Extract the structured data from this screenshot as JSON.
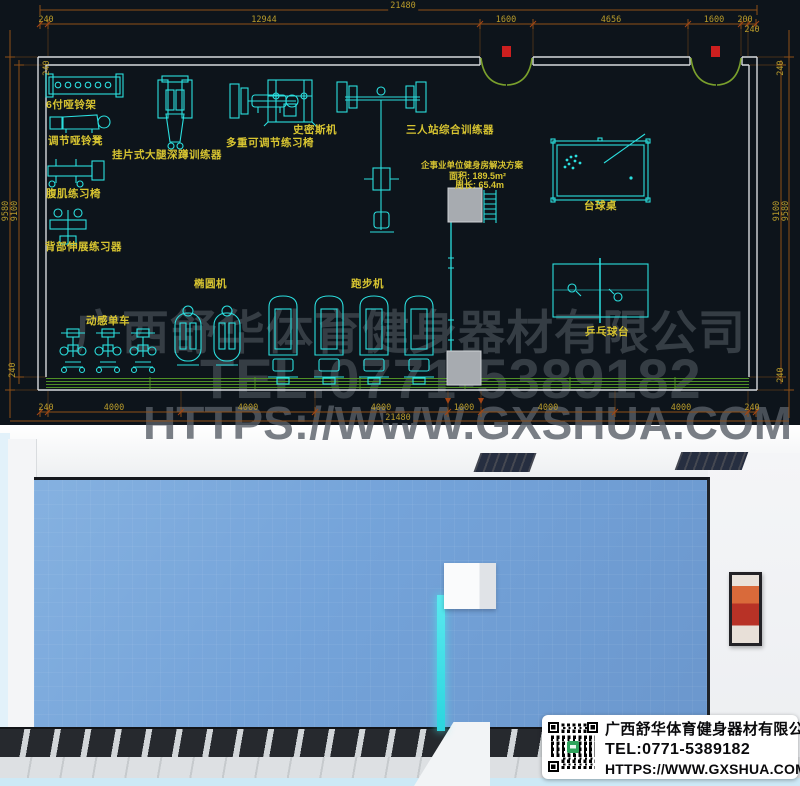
{
  "company": {
    "name": "广西舒华体育健身器材有限公司",
    "tel": "TEL:0771-5389182",
    "url": "HTTPS://WWW.GXSHUA.COM"
  },
  "plan": {
    "solution": {
      "title": "企事业单位健身房解决方案",
      "area": "面积: 189.5m²",
      "perimeter": "周长: 65.4m"
    },
    "labels": {
      "dumbbell_rack": "6付哑铃架",
      "adj_dumbbell_bench": "调节哑铃凳",
      "ab_chair": "腹肌练习椅",
      "back_extension": "背部伸展练习器",
      "squat_trainer": "挂片式大腿深蹲训练器",
      "multi_adj_bench": "多重可调节练习椅",
      "smith_machine": "史密斯机",
      "three_station": "三人站综合训练器",
      "pool_table": "台球桌",
      "pingpong_table": "乒乓球台",
      "elliptical": "椭圆机",
      "treadmill": "跑步机",
      "spin_bike": "动感单车"
    },
    "dimensions": {
      "total": "21480",
      "top_row": [
        "240",
        "12944",
        "1600",
        "4656",
        "1600",
        "200",
        "240"
      ],
      "bottom_row": [
        "240",
        "4000",
        "4000",
        "4000",
        "1000",
        "4000",
        "4000",
        "240"
      ],
      "side": {
        "wall": "240",
        "inner": "9100",
        "outer": "9580"
      }
    }
  },
  "colors": {
    "cad_background": "#0d141b",
    "cad_line_cyan": "#2bdfdf",
    "cad_label_yellow": "#d8c531",
    "cad_dim_orange": "#8e4f17",
    "cad_dim_text": "#b89b2b",
    "wall_white": "#d7dadd",
    "door_green": "#7aa02c",
    "door_marker_red": "#cc1f1f",
    "floor_blue": "#74a3d9",
    "pool_felt_green": "#2e7c33",
    "pingpong_blue": "#3e6ea6",
    "cyan_glow": "#3fe3ea",
    "watermark_gray": "#585e66"
  }
}
